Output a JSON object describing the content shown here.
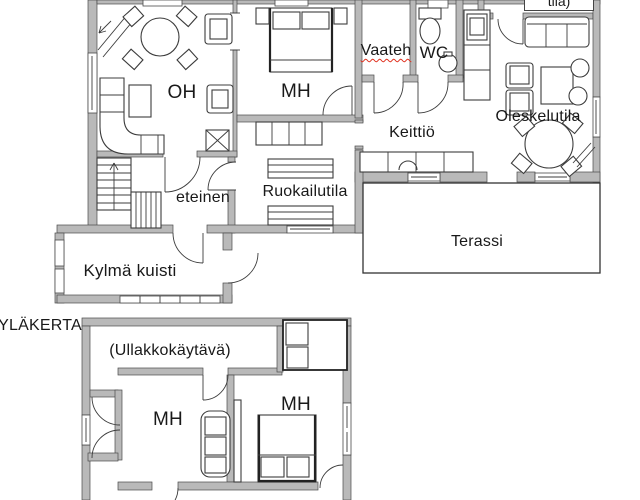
{
  "floorplan": {
    "upper_floor_heading": "YLÄKERTA",
    "ground_floor": {
      "living_room": "OH",
      "bedroom": "MH",
      "walk_in_closet": "Vaateh",
      "wc": "WC",
      "kitchen": "Keittiö",
      "lounge": "Oleskelutila",
      "dining_area": "Ruokailutila",
      "hallway": "eteinen",
      "cold_porch": "Kylmä kuisti",
      "terrace": "Terassi",
      "cutoff_room_label_partial": "tila)"
    },
    "upper_floor": {
      "attic_corridor": "(Ullakkokäytävä)",
      "bedroom_left": "MH",
      "bedroom_right": "MH"
    },
    "colors": {
      "background": "#ffffff",
      "wall_fill": "#b9b9b9",
      "wall_stroke": "#4a4a4a",
      "drawing_line": "#3c3c3c",
      "text": "#191919",
      "spellcheck_underline": "#e0301e"
    }
  }
}
